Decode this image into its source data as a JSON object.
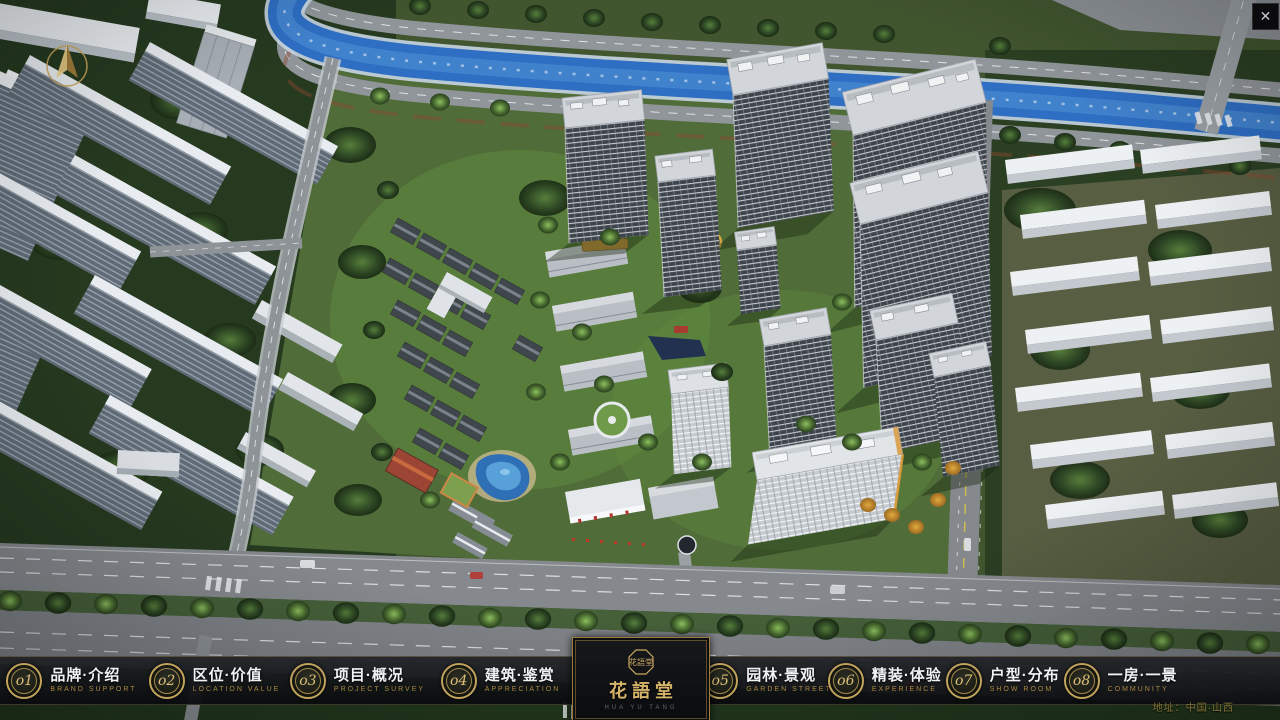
{
  "window": {
    "close_label": "✕"
  },
  "nav": {
    "items": [
      {
        "num": "o1",
        "zh": "品牌·介绍",
        "en": "BRAND SUPPORT"
      },
      {
        "num": "o2",
        "zh": "区位·价值",
        "en": "LOCATION VALUE"
      },
      {
        "num": "o3",
        "zh": "项目·概况",
        "en": "PROJECT SURVEY"
      },
      {
        "num": "o4",
        "zh": "建筑·鉴赏",
        "en": "APPRECIATION"
      },
      {
        "num": "o5",
        "zh": "园林·景观",
        "en": "GARDEN STREET"
      },
      {
        "num": "o6",
        "zh": "精装·体验",
        "en": "EXPERIENCE"
      },
      {
        "num": "o7",
        "zh": "户型·分布",
        "en": "SHOW ROOM"
      },
      {
        "num": "o8",
        "zh": "一房·一景",
        "en": "COMMUNITY"
      }
    ]
  },
  "logo": {
    "seal": "花語堂",
    "title": "花語堂",
    "subtitle": "HUA YU TANG"
  },
  "footer": {
    "address": "地址：中国·山西"
  },
  "colors": {
    "gold": "#c2a35c",
    "bar_bg": "#0f1114",
    "river_blue": "#2e6ec3",
    "tree_green": "#3c5c2c",
    "roof_gray": "#d2d6da"
  }
}
